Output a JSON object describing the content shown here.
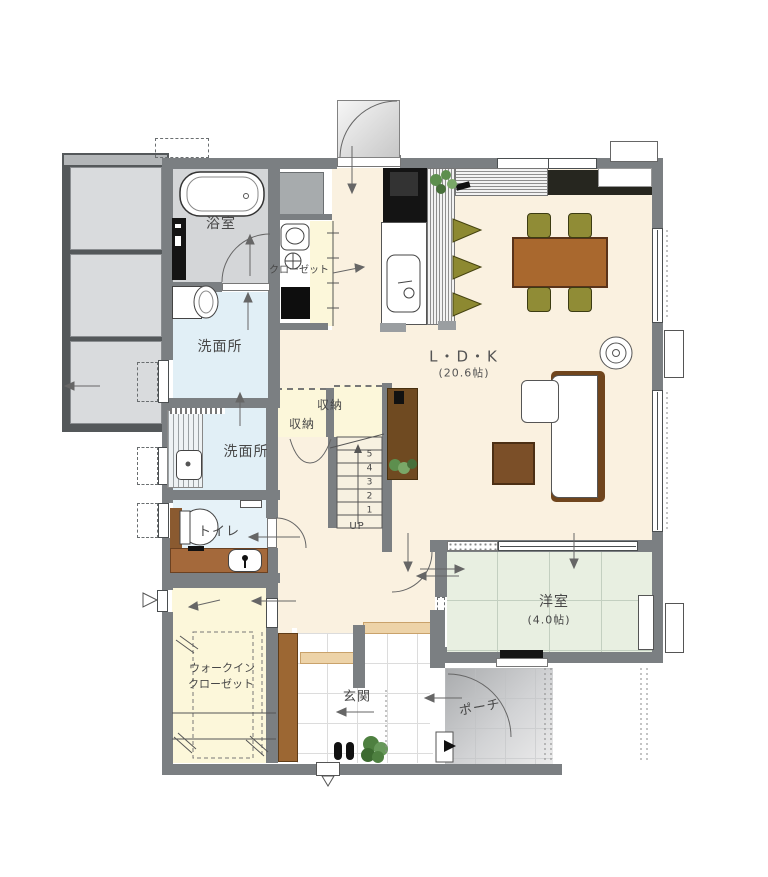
{
  "labels": {
    "bathroom": "浴室",
    "closet": "クローゼット",
    "washroom_upper": "洗面所",
    "washroom_lower": "洗面所",
    "storage_upper": "収納",
    "storage_lower": "収納",
    "toilet": "トイレ",
    "ldk": "L・D・K",
    "ldk_size": "(20.6帖)",
    "western_room": "洋室",
    "western_room_size": "(4.0帖)",
    "wic_line1": "ウォークイン",
    "wic_line2": "クローゼット",
    "entrance": "玄関",
    "porch": "ポーチ",
    "stairs_up": "UP",
    "stair_numbers": [
      "5",
      "4",
      "3",
      "2",
      "1"
    ]
  },
  "colors": {
    "wall": "#7b7f82",
    "ldk_floor": "#faf1e0",
    "wet_room_floor": "#e1eff6",
    "storage_floor": "#fcf7da",
    "tatami_floor": "#e8efe1",
    "bathroom_floor": "#d4d6d8",
    "genkan_tile": "#ffffff",
    "porch_gray": "#b4b6b8",
    "wood_brown": "#a9682e",
    "dark_brown": "#70451d",
    "olive_chair": "#908c36",
    "step_tan": "#edd3a8",
    "cabinet_brown": "#9c6733"
  }
}
